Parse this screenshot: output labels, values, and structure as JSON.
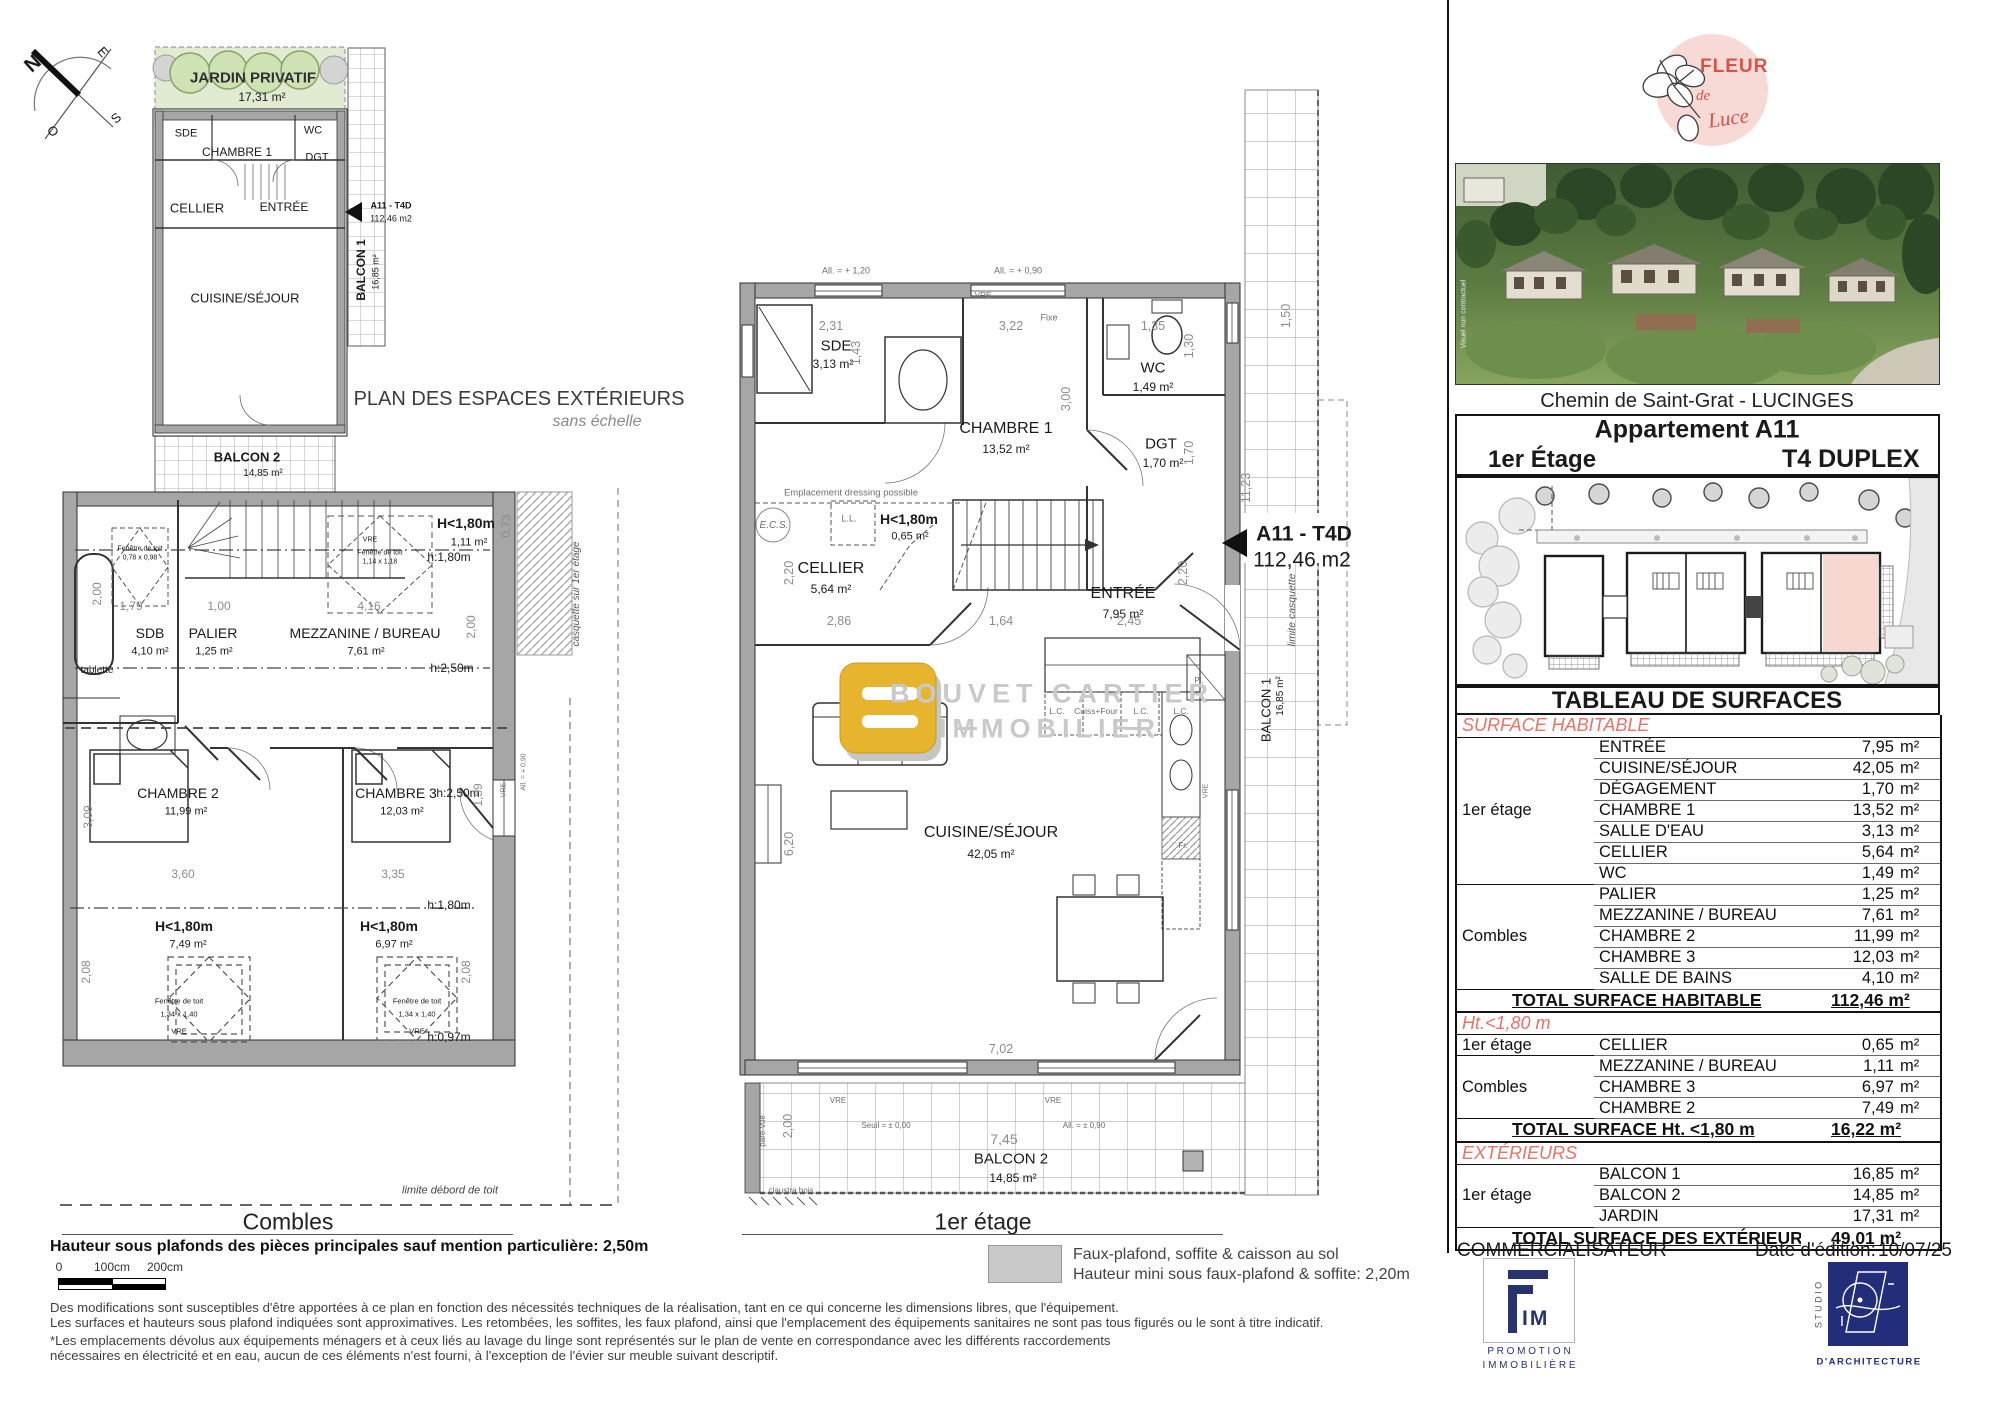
{
  "compass": {
    "n": "N",
    "e": "E",
    "s": "S",
    "o": "O"
  },
  "plan_ext": {
    "title": "PLAN DES ESPACES EXTÉRIEURS",
    "subtitle": "sans échelle",
    "jardin": {
      "name": "JARDIN PRIVATIF",
      "area": "17,31 m²"
    },
    "sde": "SDE",
    "ch1": "CHAMBRE 1",
    "wc": "WC",
    "dgt": "DGT",
    "cellier": "CELLIER",
    "entree": "ENTRÉE",
    "cs": "CUISINE/SÉJOUR",
    "balcon1": {
      "name": "BALCON 1",
      "area": "16,85 m²"
    },
    "balcon2": {
      "name": "BALCON 2",
      "area": "14,85 m²"
    },
    "unit": {
      "code": "A11 - T4D",
      "area": "112,46 m2"
    }
  },
  "combles": {
    "title": "Combles",
    "rooms": {
      "sdb": {
        "name": "SDB",
        "area": "4,10 m²"
      },
      "palier": {
        "name": "PALIER",
        "area": "1,25 m²"
      },
      "mezz": {
        "name": "MEZZANINE / BUREAU",
        "area": "7,61 m²"
      },
      "h1": {
        "name": "H<1,80m",
        "area": "1,11 m²"
      },
      "ch2": {
        "name": "CHAMBRE 2",
        "area": "11,99 m²"
      },
      "ch3": {
        "name": "CHAMBRE 3",
        "area": "12,03 m²"
      },
      "h2": {
        "name": "H<1,80m",
        "area": "7,49 m²"
      },
      "h3": {
        "name": "H<1,80m",
        "area": "6,97 m²"
      }
    },
    "heights": {
      "h180": "h:1,80m",
      "h250": "h:2,50m",
      "h097": "h:0,97m"
    },
    "ann": {
      "tablette": "tablette",
      "fen_small": "Fenêtre de toit",
      "fen_small_dim": "0,78 x 0,98",
      "fen_mid": "Fenêtre de toit",
      "fen_mid_dim": "1,14 x 1,18",
      "fen": "Fenêtre de toit",
      "fen_dim": "1,34 x 1,40",
      "vre": "VRE",
      "all090": "All. = + 0,90",
      "casquette": "casquette sur 1er étage",
      "limite": "limite débord de toit"
    },
    "dims": [
      "2,00",
      "1,79",
      "1,00",
      "4,16",
      "0,73",
      "2,00",
      "3,09",
      "3,60",
      "3,35",
      "2,08",
      "2,08",
      "1,59"
    ]
  },
  "etage1": {
    "title": "1er étage",
    "rooms": {
      "sde": {
        "name": "SDE",
        "area": "3,13 m²"
      },
      "ch1": {
        "name": "CHAMBRE 1",
        "area": "13,52 m²"
      },
      "wc": {
        "name": "WC",
        "area": "1,49 m²"
      },
      "dgt": {
        "name": "DGT",
        "area": "1,70 m²"
      },
      "cellier": {
        "name": "CELLIER",
        "area": "5,64 m²"
      },
      "h180": {
        "name": "H<1,80m",
        "area": "0,65 m²"
      },
      "entree": {
        "name": "ENTRÉE",
        "area": "7,95 m²"
      },
      "cs": {
        "name": "CUISINE/SÉJOUR",
        "area": "42,05 m²"
      },
      "b1": {
        "name": "BALCON 1",
        "area": "16,85 m²"
      },
      "b2": {
        "name": "BALCON 2",
        "area": "14,85 m²"
      }
    },
    "unit": {
      "code": "A11 - T4D",
      "area": "112,46 m2"
    },
    "ann": {
      "all120": "All. = + 1,20",
      "all090": "All. = + 0,90",
      "vre": "VRE",
      "fixe": "Fixe",
      "dressing": "Emplacement dressing possible",
      "ecs": "E.C.S.",
      "ll": "L.L.",
      "lc": "L.C.",
      "cuiss": "Cuiss+Four",
      "pl": "Pl.",
      "fr": "Fr.",
      "seuil": "Seuil = ± 0,00",
      "all_pm": "All. = ± 0,90",
      "pare": "pare-vue",
      "claustra": "claustra bois",
      "limite_casq": "limite casquette"
    },
    "watermark": {
      "l1": "BOUVET CARTIER",
      "l2": "IMMOBILIER"
    },
    "dims": [
      "2,31",
      "1,43",
      "3,22",
      "3,00",
      "1,35",
      "1,30",
      "1,70",
      "2,86",
      "1,64",
      "2,45",
      "2,20",
      "2,20",
      "6,20",
      "7,02",
      "7,45",
      "2,00",
      "11,23",
      "1,50"
    ]
  },
  "legend": {
    "l1": "Faux-plafond, soffite & caisson au sol",
    "l2": "Hauteur mini sous faux-plafond & soffite: 2,20m"
  },
  "notes": {
    "bold": "Hauteur sous plafonds des pièces principales sauf mention particulière: 2,50m",
    "scale": [
      "0",
      "100cm",
      "200cm"
    ],
    "lines": [
      "Des modifications sont susceptibles d'être apportées à ce plan en fonction des nécessités techniques de la réalisation, tant en ce qui concerne les dimensions libres, que l'équipement.",
      "Les surfaces et hauteurs sous plafond indiquées sont approximatives. Les retombées, les soffites, les faux plafond, ainsi que l'emplacement des équipements sanitaires ne sont pas tous figurés ou le sont à titre indicatif.",
      "*Les emplacements dévolus aux équipements ménagers et à ceux liés au lavage du linge sont représentés sur le plan de vente en correspondance avec les différents raccordements",
      "nécessaires en électricité et en eau, aucun de ces éléments n'est fourni, à l'exception de l'évier sur meuble suivant descriptif."
    ]
  },
  "panel": {
    "logo": {
      "l1": "FLEUR",
      "l2": "de",
      "l3": "Luce"
    },
    "photo_caption": "Visuel non contractuel",
    "address": "Chemin de Saint-Grat - LUCINGES",
    "header": {
      "title": "Appartement A11",
      "floor": "1er Étage",
      "type": "T4 DUPLEX"
    },
    "table": {
      "title": "TABLEAU DE SURFACES",
      "unit": "m²",
      "s1": {
        "label": "SURFACE HABITABLE",
        "g1": "1er étage",
        "g1rows": [
          {
            "n": "ENTRÉE",
            "v": "7,95"
          },
          {
            "n": "CUISINE/SÉJOUR",
            "v": "42,05"
          },
          {
            "n": "DÉGAGEMENT",
            "v": "1,70"
          },
          {
            "n": "CHAMBRE 1",
            "v": "13,52"
          },
          {
            "n": "SALLE D'EAU",
            "v": "3,13"
          },
          {
            "n": "CELLIER",
            "v": "5,64"
          },
          {
            "n": "WC",
            "v": "1,49"
          }
        ],
        "g2": "Combles",
        "g2rows": [
          {
            "n": "PALIER",
            "v": "1,25"
          },
          {
            "n": "MEZZANINE / BUREAU",
            "v": "7,61"
          },
          {
            "n": "CHAMBRE 2",
            "v": "11,99"
          },
          {
            "n": "CHAMBRE 3",
            "v": "12,03"
          },
          {
            "n": "SALLE DE BAINS",
            "v": "4,10"
          }
        ],
        "total": {
          "label": "TOTAL SURFACE HABITABLE",
          "value": "112,46 m²"
        }
      },
      "s2": {
        "label": "Ht.<1,80 m",
        "g1": "1er étage",
        "g1rows": [
          {
            "n": "CELLIER",
            "v": "0,65"
          }
        ],
        "g2": "Combles",
        "g2rows": [
          {
            "n": "MEZZANINE / BUREAU",
            "v": "1,11"
          },
          {
            "n": "CHAMBRE 3",
            "v": "6,97"
          },
          {
            "n": "CHAMBRE 2",
            "v": "7,49"
          }
        ],
        "total": {
          "label": "TOTAL SURFACE Ht. <1,80 m",
          "value": "16,22 m²"
        }
      },
      "s3": {
        "label": "EXTÉRIEURS",
        "g1": "1er étage",
        "g1rows": [
          {
            "n": "BALCON 1",
            "v": "16,85"
          },
          {
            "n": "BALCON 2",
            "v": "14,85"
          },
          {
            "n": "JARDIN",
            "v": "17,31"
          }
        ],
        "total": {
          "label": "TOTAL SURFACE  DES EXTÉRIEURS",
          "value": "49,01 m²"
        }
      }
    },
    "footer": {
      "commercial": "COMMERCIALISATEUR",
      "date_label": "Date d'édition:",
      "date": "10/07/25"
    },
    "fim": {
      "mark": "IM",
      "l1": "P R O M O T I O N",
      "l2": "I M M O B I L I È R E"
    },
    "studio": {
      "vertical": "S T U D I O",
      "label": "D'ARCHITECTURE"
    }
  }
}
